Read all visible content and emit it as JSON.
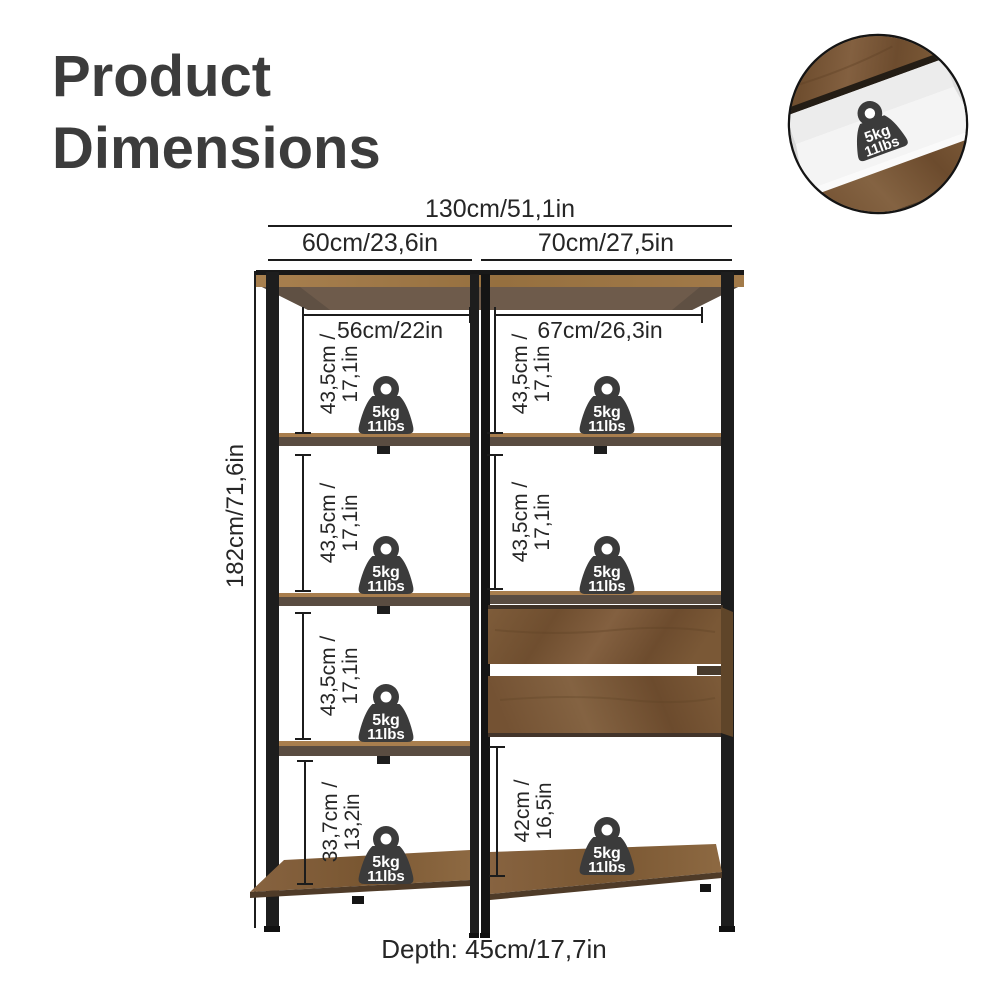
{
  "title": {
    "line1": "Product",
    "line2": "Dimensions"
  },
  "weight_badge": {
    "kg": "5kg",
    "lbs": "11lbs"
  },
  "dimensions": {
    "overall_width": "130cm/51,1in",
    "left_column_width": "60cm/23,6in",
    "right_column_width": "70cm/27,5in",
    "left_inner_width": "56cm/22in",
    "right_inner_width": "67cm/26,3in",
    "overall_height": "182cm/71,6in",
    "standard_gap": {
      "line1": "43,5cm /",
      "line2": "17,1in"
    },
    "left_bottom_gap": {
      "line1": "33,7cm /",
      "line2": "13,2in"
    },
    "right_bottom_gap": {
      "line1": "42cm /",
      "line2": "16,5in"
    },
    "depth": "Depth: 45cm/17,7in"
  },
  "colors": {
    "text": "#262626",
    "title": "#3c3c3c",
    "frame": "#1d1d1d",
    "wood_light": "#a87e4e",
    "wood_mid": "#7e5c3a",
    "wood_dark": "#5f4529",
    "badge": "#3b3b3b"
  }
}
